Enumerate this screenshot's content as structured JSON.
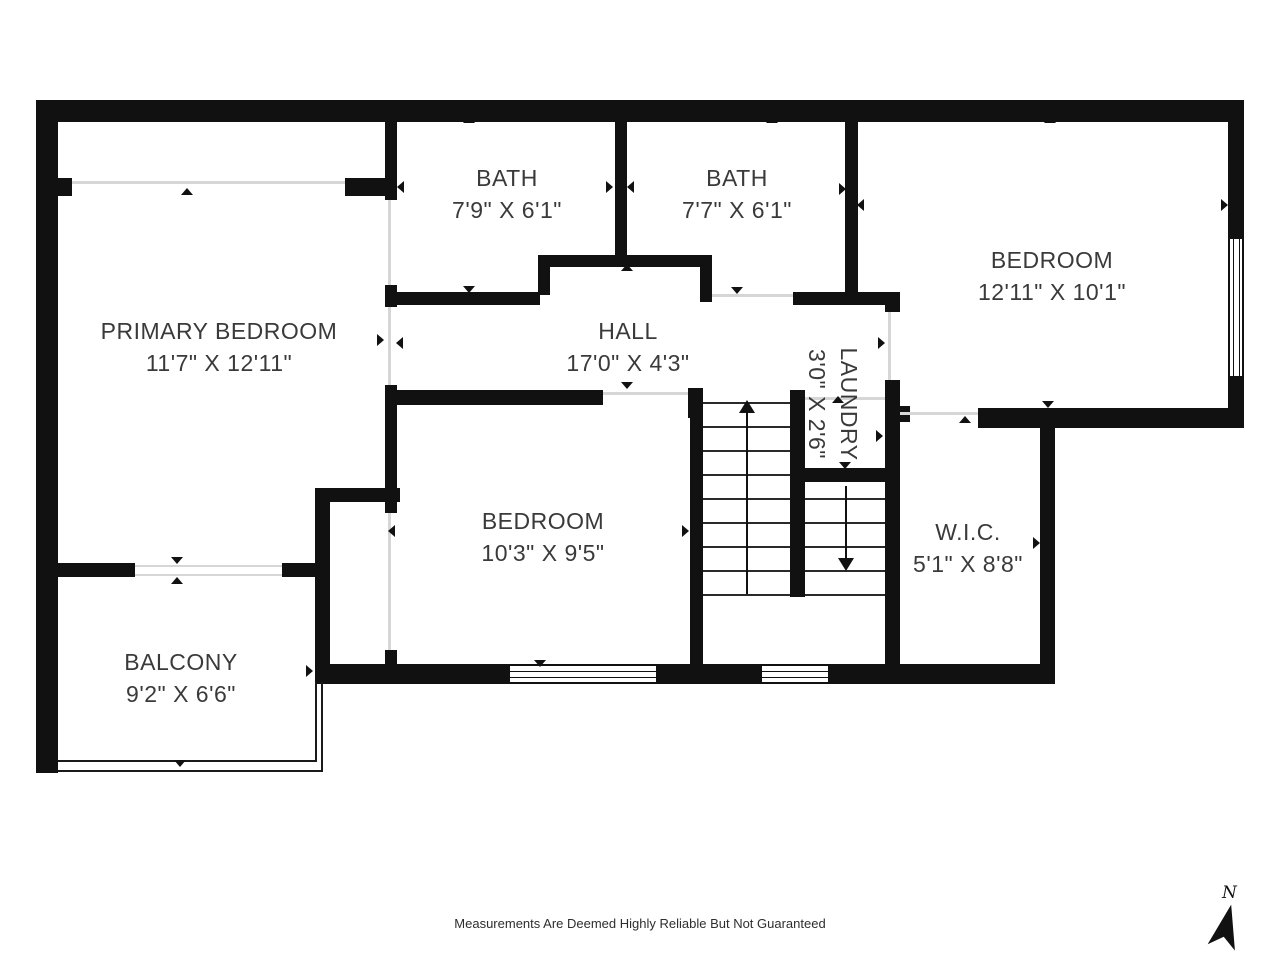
{
  "footer": {
    "disclaimer": "Measurements Are Deemed Highly Reliable But Not Guaranteed"
  },
  "compass": {
    "label": "N"
  },
  "colors": {
    "wall": "#111111",
    "label_text": "#3a3a3a",
    "opening_line": "#d6d6d6"
  },
  "rooms": [
    {
      "id": "primary-bedroom",
      "name": "PRIMARY BEDROOM",
      "dims": "11'7\" X 12'11\"",
      "cx": 219,
      "cy": 347,
      "rotated": false
    },
    {
      "id": "bath-1",
      "name": "BATH",
      "dims": "7'9\" X 6'1\"",
      "cx": 507,
      "cy": 194,
      "rotated": false
    },
    {
      "id": "bath-2",
      "name": "BATH",
      "dims": "7'7\" X 6'1\"",
      "cx": 737,
      "cy": 194,
      "rotated": false
    },
    {
      "id": "bedroom-right",
      "name": "BEDROOM",
      "dims": "12'11\" X 10'1\"",
      "cx": 1052,
      "cy": 276,
      "rotated": false
    },
    {
      "id": "hall",
      "name": "HALL",
      "dims": "17'0\" X 4'3\"",
      "cx": 628,
      "cy": 347,
      "rotated": false
    },
    {
      "id": "laundry",
      "name": "LAUNDRY",
      "dims": "3'0\" X 2'6\"",
      "cx": 833,
      "cy": 404,
      "rotated": true
    },
    {
      "id": "bedroom-middle",
      "name": "BEDROOM",
      "dims": "10'3\" X 9'5\"",
      "cx": 543,
      "cy": 537,
      "rotated": false
    },
    {
      "id": "wic",
      "name": "W.I.C.",
      "dims": "5'1\" X 8'8\"",
      "cx": 968,
      "cy": 548,
      "rotated": false
    },
    {
      "id": "balcony",
      "name": "BALCONY",
      "dims": "9'2\" X 6'6\"",
      "cx": 181,
      "cy": 678,
      "rotated": false
    }
  ],
  "walls": [
    [
      36,
      100,
      1208,
      22
    ],
    [
      36,
      100,
      22,
      673
    ],
    [
      1228,
      100,
      16,
      328
    ],
    [
      315,
      664,
      740,
      20
    ],
    [
      1040,
      423,
      15,
      261
    ],
    [
      978,
      408,
      266,
      20
    ],
    [
      36,
      178,
      36,
      18
    ],
    [
      345,
      178,
      52,
      18
    ],
    [
      385,
      100,
      12,
      100
    ],
    [
      385,
      285,
      12,
      22
    ],
    [
      385,
      385,
      12,
      128
    ],
    [
      385,
      650,
      12,
      22
    ],
    [
      615,
      100,
      12,
      158
    ],
    [
      538,
      255,
      165,
      12
    ],
    [
      538,
      255,
      12,
      40
    ],
    [
      395,
      292,
      145,
      13
    ],
    [
      700,
      255,
      12,
      47
    ],
    [
      845,
      100,
      13,
      192
    ],
    [
      793,
      292,
      107,
      13
    ],
    [
      885,
      292,
      15,
      20
    ],
    [
      885,
      380,
      15,
      304
    ],
    [
      397,
      390,
      206,
      15
    ],
    [
      688,
      388,
      15,
      30
    ],
    [
      690,
      390,
      13,
      294
    ],
    [
      790,
      390,
      15,
      207
    ],
    [
      805,
      468,
      95,
      14
    ],
    [
      36,
      563,
      99,
      14
    ],
    [
      282,
      563,
      35,
      14
    ],
    [
      315,
      488,
      15,
      194
    ],
    [
      315,
      488,
      85,
      14
    ],
    [
      898,
      406,
      12,
      16
    ]
  ],
  "openings": [
    [
      72,
      181,
      273,
      3
    ],
    [
      388,
      200,
      3,
      85
    ],
    [
      388,
      307,
      3,
      78
    ],
    [
      388,
      513,
      3,
      137
    ],
    [
      712,
      294,
      81,
      3
    ],
    [
      135,
      565,
      147,
      2
    ],
    [
      135,
      574,
      147,
      2
    ],
    [
      603,
      392,
      85,
      3
    ],
    [
      888,
      312,
      3,
      68
    ],
    [
      900,
      412,
      78,
      3
    ],
    [
      805,
      397,
      80,
      3
    ]
  ],
  "windows": [
    {
      "x": 1228,
      "y": 237,
      "w": 16,
      "h": 141,
      "orient": "v"
    },
    {
      "x": 508,
      "y": 664,
      "w": 150,
      "h": 20,
      "orient": "h"
    },
    {
      "x": 760,
      "y": 664,
      "w": 70,
      "h": 20,
      "orient": "h"
    }
  ],
  "railings": [
    [
      58,
      760,
      259,
      2
    ],
    [
      58,
      770,
      265,
      2
    ],
    [
      315,
      682,
      2,
      80
    ],
    [
      321,
      682,
      2,
      90
    ]
  ],
  "stairs": {
    "flights": [
      {
        "x1": 703,
        "x2": 790,
        "treads": [
          402,
          426,
          450,
          474,
          498,
          522,
          546,
          570,
          594
        ],
        "centerX": 746,
        "arrow": {
          "dir": "up",
          "y1": 400,
          "y2": 594
        }
      },
      {
        "x1": 805,
        "x2": 885,
        "treads": [
          498,
          522,
          546,
          570,
          594
        ],
        "centerX": 845,
        "arrow": {
          "dir": "down",
          "y1": 486,
          "y2": 570
        }
      }
    ]
  },
  "extent_arrows": [
    {
      "dir": "up",
      "x": 187,
      "y": 192
    },
    {
      "dir": "left",
      "x": 52,
      "y": 343
    },
    {
      "dir": "right",
      "x": 380,
      "y": 340
    },
    {
      "dir": "down",
      "x": 177,
      "y": 560
    },
    {
      "dir": "up",
      "x": 177,
      "y": 581
    },
    {
      "dir": "left",
      "x": 52,
      "y": 671
    },
    {
      "dir": "right",
      "x": 309,
      "y": 671
    },
    {
      "dir": "down",
      "x": 180,
      "y": 763
    },
    {
      "dir": "up",
      "x": 469,
      "y": 120
    },
    {
      "dir": "left",
      "x": 401,
      "y": 187
    },
    {
      "dir": "right",
      "x": 609,
      "y": 187
    },
    {
      "dir": "down",
      "x": 469,
      "y": 289
    },
    {
      "dir": "up",
      "x": 772,
      "y": 120
    },
    {
      "dir": "left",
      "x": 631,
      "y": 187
    },
    {
      "dir": "right",
      "x": 842,
      "y": 189
    },
    {
      "dir": "down",
      "x": 737,
      "y": 290
    },
    {
      "dir": "up",
      "x": 1050,
      "y": 120
    },
    {
      "dir": "left",
      "x": 861,
      "y": 205
    },
    {
      "dir": "right",
      "x": 1224,
      "y": 205
    },
    {
      "dir": "down",
      "x": 1048,
      "y": 404
    },
    {
      "dir": "up",
      "x": 627,
      "y": 268
    },
    {
      "dir": "left",
      "x": 400,
      "y": 343
    },
    {
      "dir": "right",
      "x": 881,
      "y": 343
    },
    {
      "dir": "down",
      "x": 627,
      "y": 385
    },
    {
      "dir": "up",
      "x": 838,
      "y": 400
    },
    {
      "dir": "left",
      "x": 800,
      "y": 436
    },
    {
      "dir": "right",
      "x": 879,
      "y": 436
    },
    {
      "dir": "down",
      "x": 845,
      "y": 465
    },
    {
      "dir": "up",
      "x": 540,
      "y": 398
    },
    {
      "dir": "left",
      "x": 392,
      "y": 531
    },
    {
      "dir": "right",
      "x": 685,
      "y": 531
    },
    {
      "dir": "down",
      "x": 540,
      "y": 663
    },
    {
      "dir": "up",
      "x": 965,
      "y": 420
    },
    {
      "dir": "left",
      "x": 894,
      "y": 543
    },
    {
      "dir": "right",
      "x": 1036,
      "y": 543
    },
    {
      "dir": "down",
      "x": 965,
      "y": 667
    }
  ]
}
